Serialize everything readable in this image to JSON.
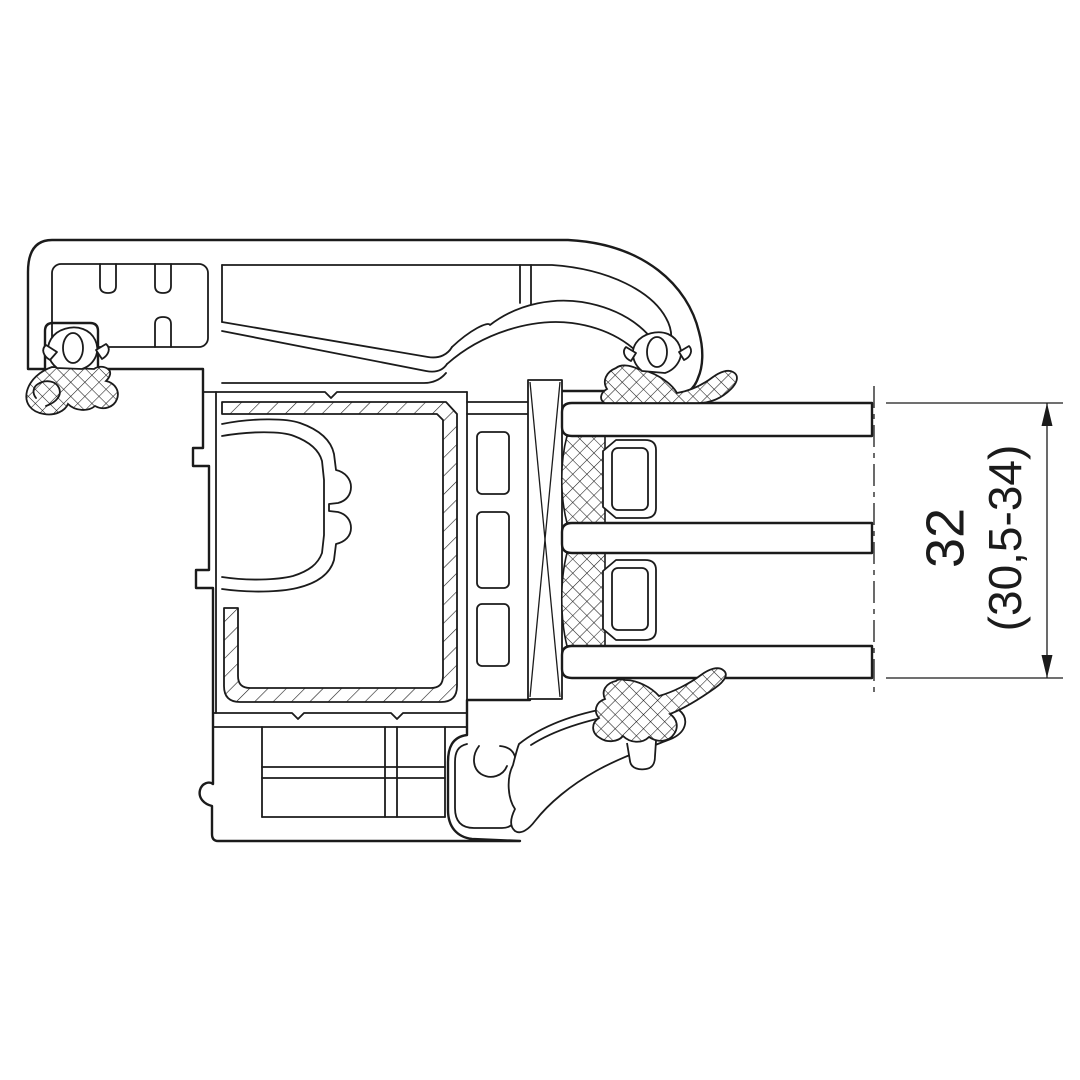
{
  "dimension": {
    "nominal_label": "32",
    "range_label": "(30,5-34)"
  },
  "colors": {
    "line_color": "#1b1b1b",
    "background_color": "#ffffff"
  }
}
